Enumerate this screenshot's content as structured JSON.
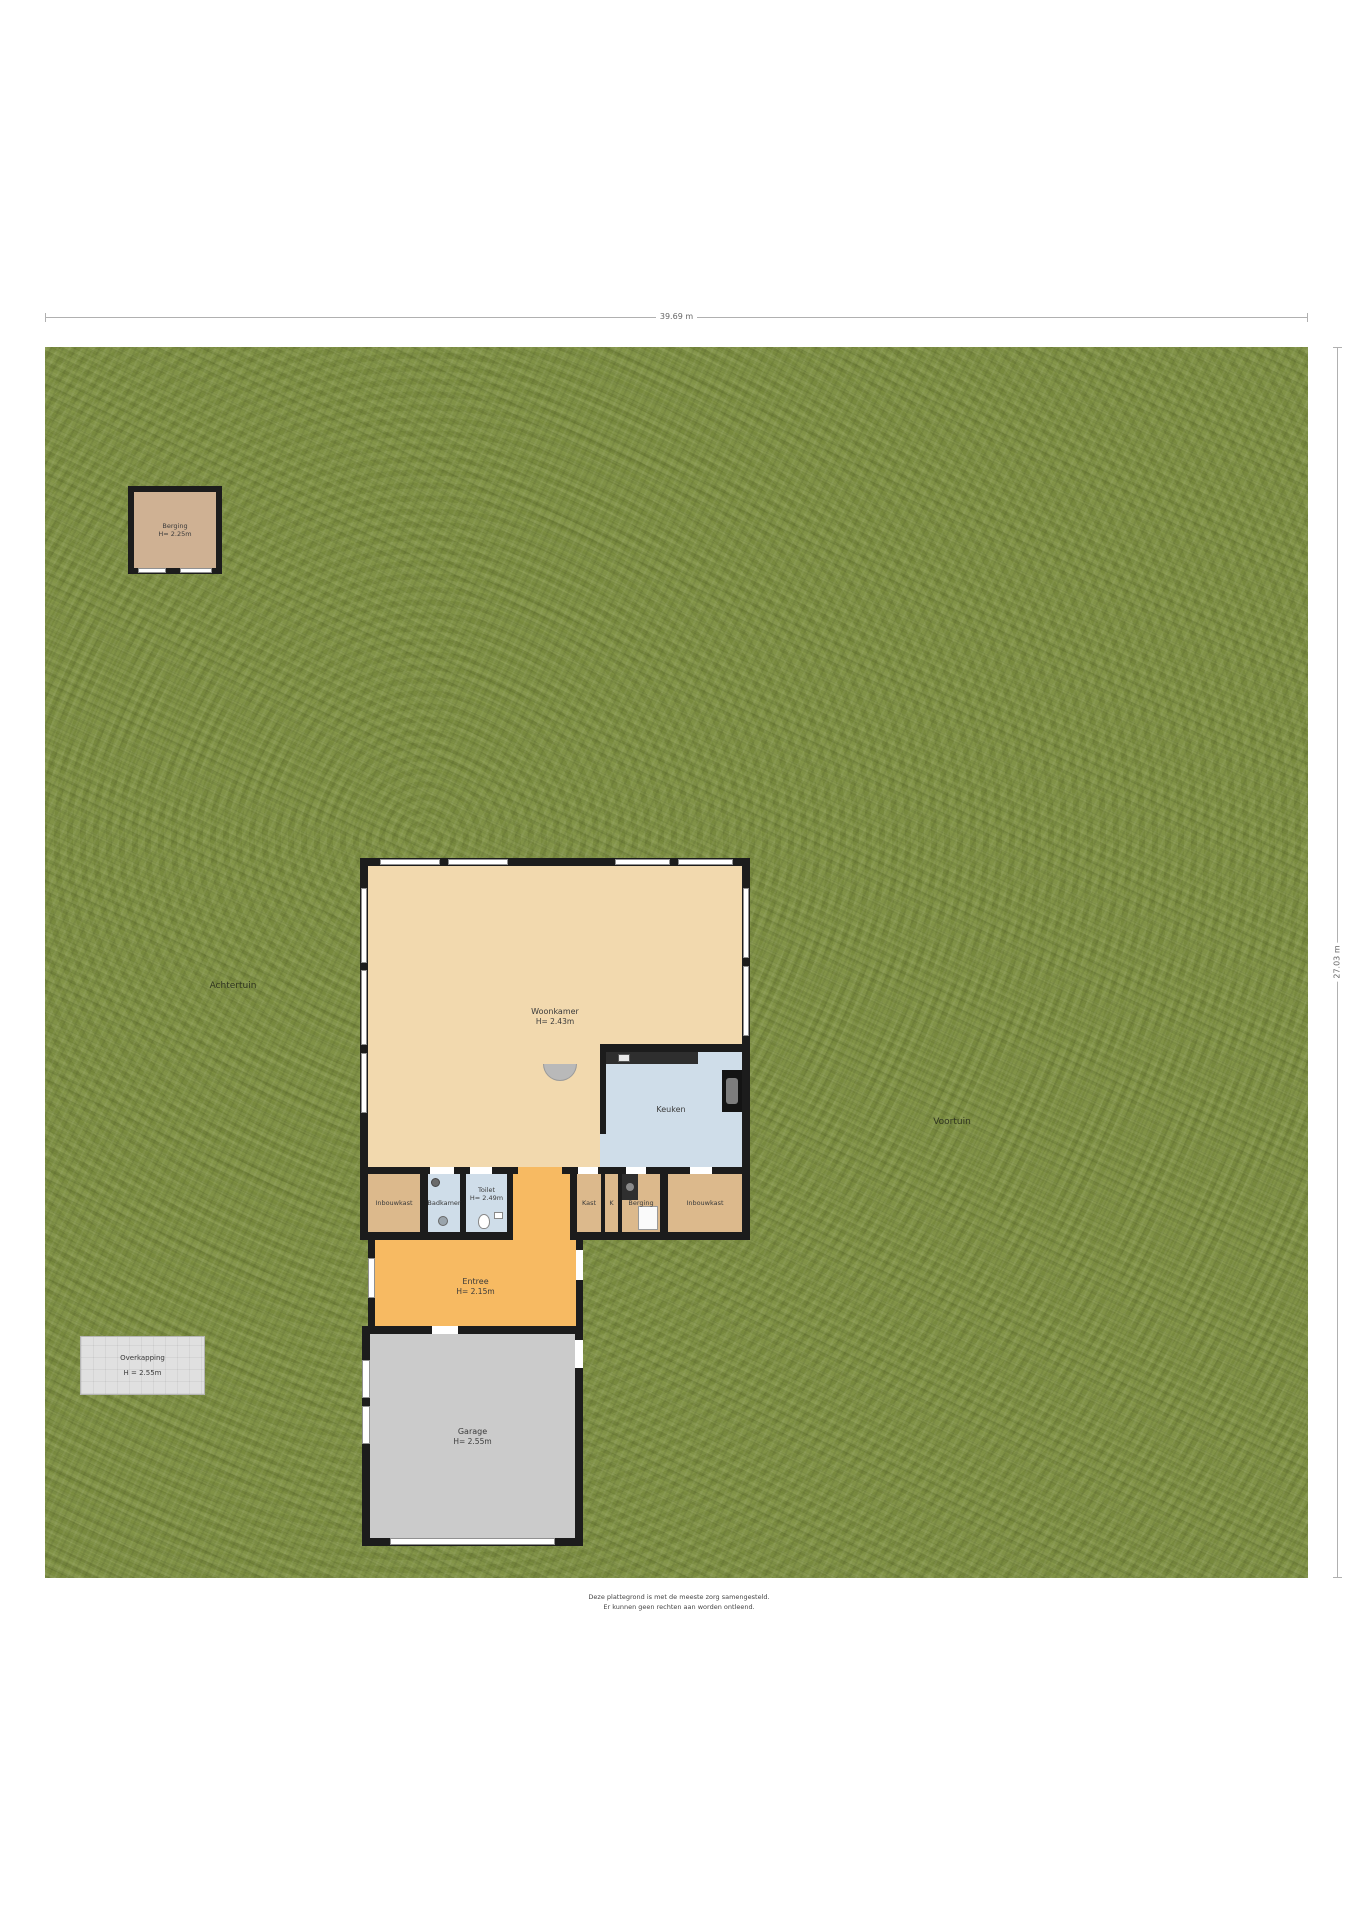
{
  "dimensions": {
    "width_label": "39.69 m",
    "height_label": "27.03 m"
  },
  "garden": {
    "achtertuin": "Achtertuin",
    "voortuin": "Voortuin"
  },
  "shed": {
    "name": "Berging",
    "height": "H= 2.25m"
  },
  "overkapping": {
    "name": "Overkapping",
    "height": "H = 2.55m"
  },
  "rooms": {
    "woonkamer": {
      "name": "Woonkamer",
      "height": "H= 2.43m"
    },
    "keuken": {
      "name": "Keuken"
    },
    "inbouwkast_left": {
      "name": "Inbouwkast"
    },
    "badkamer": {
      "name": "Badkamer"
    },
    "toilet": {
      "name": "Toilet",
      "height": "H= 2.49m"
    },
    "kast": {
      "name": "Kast"
    },
    "k_closet": {
      "name": "K"
    },
    "berging": {
      "name": "Berging"
    },
    "inbouwkast_right": {
      "name": "Inbouwkast"
    },
    "entree": {
      "name": "Entree",
      "height": "H= 2.15m"
    },
    "garage": {
      "name": "Garage",
      "height": "H= 2.55m"
    }
  },
  "footer": {
    "line1": "Deze plattegrond is met de meeste zorg samengesteld.",
    "line2": "Er kunnen geen rechten aan worden ontleend."
  },
  "colors": {
    "grass": "#7d8f41",
    "wall": "#1c1c1c",
    "floor_tan": "#f2d9ae",
    "floor_cabinet": "#dcb98c",
    "floor_wet": "#cfdde9",
    "floor_entree": "#f7ba62",
    "floor_garage": "#cbcbcb",
    "overkapping": "#e0e0e0",
    "shed_floor": "#cfb193"
  }
}
